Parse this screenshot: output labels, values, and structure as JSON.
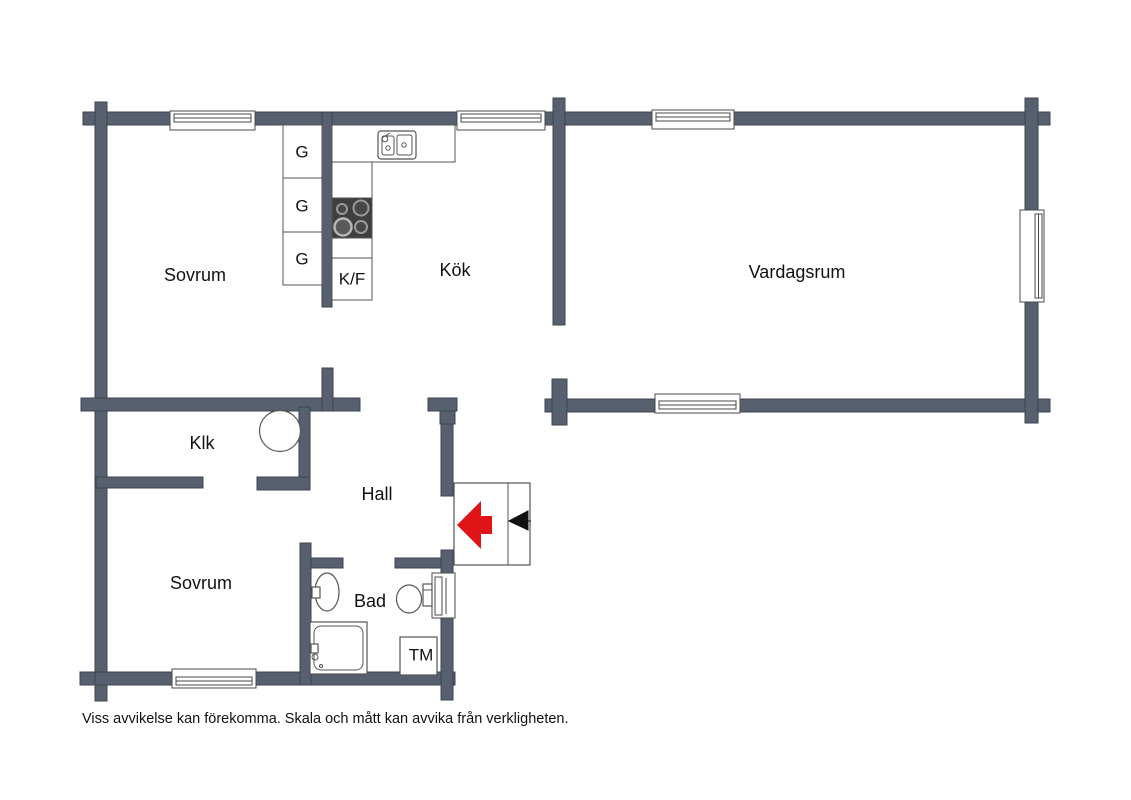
{
  "floorplan": {
    "rooms": {
      "bedroom_top": "Sovrum",
      "kitchen": "Kök",
      "living_room": "Vardagsrum",
      "closet": "Klk",
      "hall": "Hall",
      "bedroom_bottom": "Sovrum",
      "bathroom": "Bad"
    },
    "fixtures": {
      "wardrobe": "G",
      "fridge_freezer": "K/F",
      "washing_machine": "TM"
    },
    "disclaimer": "Viss avvikelse kan förekomma. Skala och mått kan avvika från verkligheten.",
    "colors": {
      "wall": "#56606F",
      "wall_outline": "#3E4551",
      "entrance_arrow": "#E01317",
      "stove": "#3F3F3F",
      "fixture_outline": "#555555"
    }
  }
}
